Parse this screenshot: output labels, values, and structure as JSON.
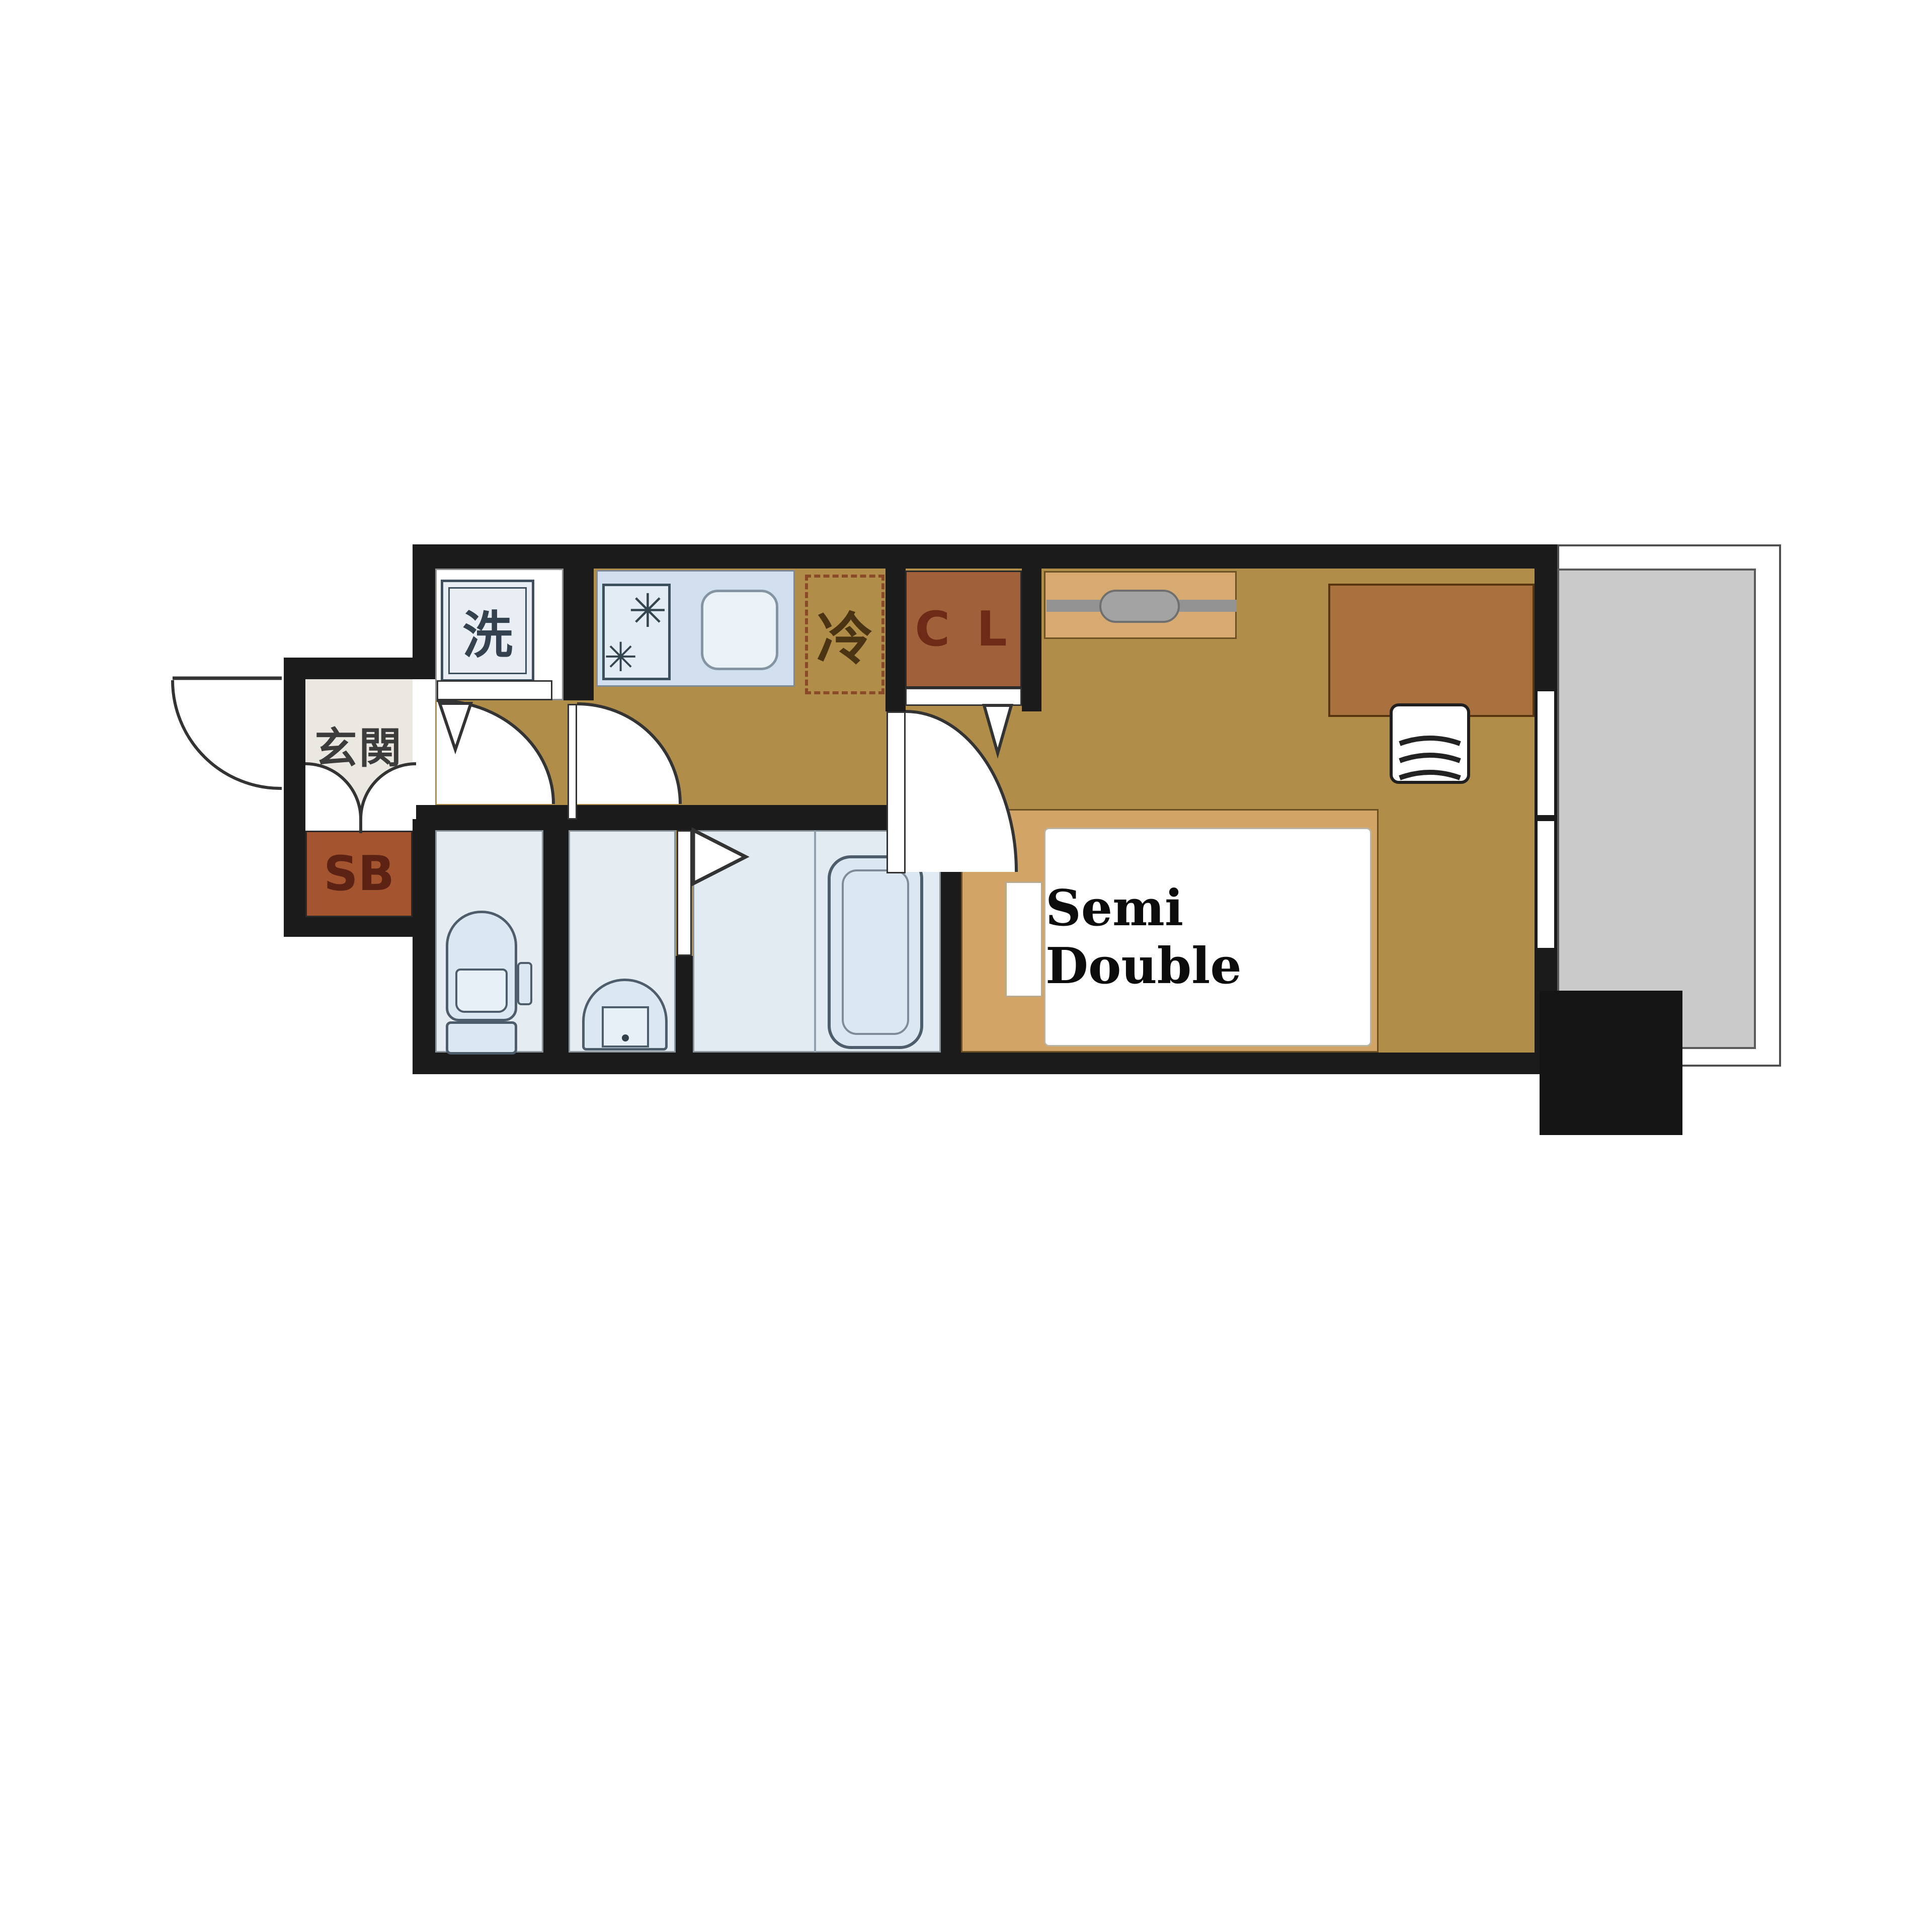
{
  "labels": {
    "genkan": "玄関",
    "shoe_box": "SB",
    "washer": "洗",
    "fridge": "冷",
    "closet": "C L",
    "bed": "Semi Double"
  },
  "icons": {
    "burner-icon": "✳",
    "burner2-icon": "✳"
  },
  "colors": {
    "wall": "#1b1b1b",
    "floor_ochre": "#b08d49",
    "wet_room_floor": "#e6edf2",
    "fixture_fill": "#dce8f1",
    "fixture_outline": "#4d5d6b",
    "counter_blue": "#d2dfee",
    "balcony_gray": "#cacaca",
    "genkan_floor": "#ebe8e2",
    "shoe_box_brown": "#a4552f",
    "closet_brown": "#a0613a",
    "bed_platform_tan": "#d2a466",
    "shelf_tan": "#d6aa70",
    "desk_brown": "#a9713e",
    "fridge_dash": "#8a4a28"
  },
  "rooms": [
    "entrance-genkan",
    "hallway",
    "laundry-room",
    "kitchen",
    "toilet",
    "washbasin-room",
    "bathroom",
    "bedroom",
    "closet",
    "balcony"
  ]
}
